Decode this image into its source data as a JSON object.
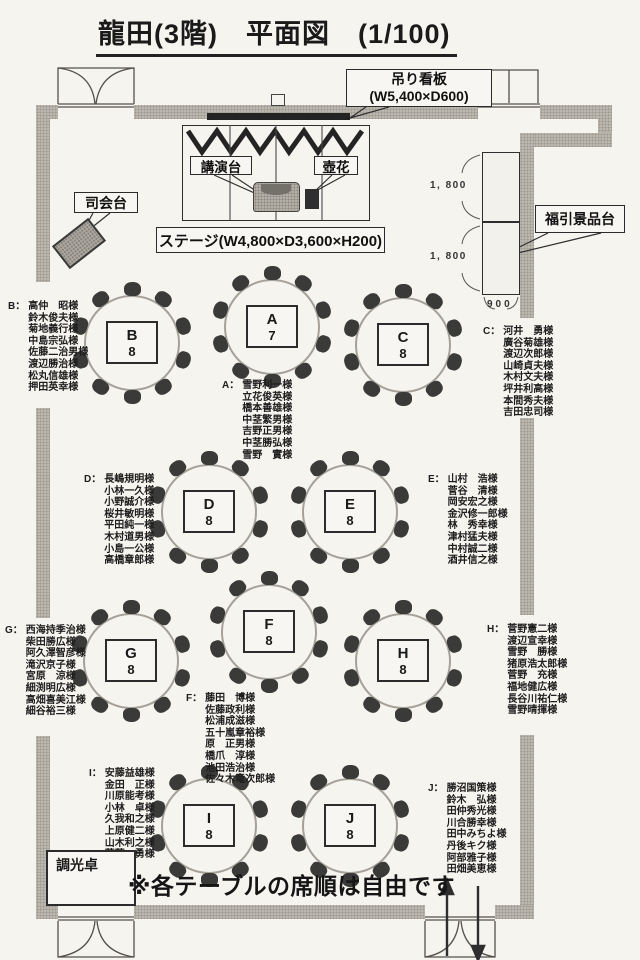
{
  "title": "龍田(3階)　平面図　(1/100)",
  "stage": {
    "label": "ステージ(W4,800×D3,600×H200)",
    "podium_label": "講演台",
    "flower_label": "壺花",
    "mc_label": "司会台",
    "sign_line1": "吊り看板",
    "sign_line2": "(W5,400×D600)"
  },
  "prize_table": {
    "label": "福引景品台",
    "dim_top": "1, 800",
    "dim_bottom": "1, 800",
    "dim_width": "900"
  },
  "dimmer_label": "調光卓",
  "note": "※各テーブルの席順は自由です",
  "tables": [
    {
      "letter": "A",
      "count": "7",
      "list_label": "A：",
      "names": [
        "雪野利一様",
        "立花俊英様",
        "橋本善雄様",
        "中茎繁男様",
        "吉野正男様",
        "中茎勝弘様",
        "雪野　實様"
      ]
    },
    {
      "letter": "B",
      "count": "8",
      "list_label": "B：",
      "names": [
        "高仲　昭様",
        "鈴木俊夫様",
        "菊地義行様",
        "中島宗弘様",
        "佐藤二治男様",
        "渡辺勝治様",
        "松丸信雄様",
        "押田英幸様"
      ]
    },
    {
      "letter": "C",
      "count": "8",
      "list_label": "C：",
      "names": [
        "河井　勇様",
        "廣谷菊雄様",
        "渡辺次郎様",
        "山崎貞夫様",
        "木村文夫様",
        "坪井利高様",
        "本間秀夫様",
        "吉田忠司様"
      ]
    },
    {
      "letter": "D",
      "count": "8",
      "list_label": "D：",
      "names": [
        "長嶋規明様",
        "小林一久様",
        "小野誠介様",
        "桜井敏明様",
        "平田純一様",
        "木村道男様",
        "小島一公様",
        "高橋章郎様"
      ]
    },
    {
      "letter": "E",
      "count": "8",
      "list_label": "E：",
      "names": [
        "山村　浩様",
        "菅谷　清様",
        "岡安宏之様",
        "金沢修一郎様",
        "林　秀幸様",
        "津村猛夫様",
        "中村誠二様",
        "酒井信之様"
      ]
    },
    {
      "letter": "F",
      "count": "8",
      "list_label": "F：",
      "names": [
        "藤田　博様",
        "佐藤政利様",
        "松浦成滋様",
        "五十嵐章裕様",
        "原　正男様",
        "橋爪　淳様",
        "池田浩治様",
        "佐々木竜次郎様"
      ]
    },
    {
      "letter": "G",
      "count": "8",
      "list_label": "G：",
      "names": [
        "西海持季治様",
        "柴田勝広様",
        "阿久澤智彦様",
        "滝沢京子様",
        "宮原　涼様",
        "細渕明広様",
        "高畑喜美江様",
        "細谷裕三様"
      ]
    },
    {
      "letter": "H",
      "count": "8",
      "list_label": "H：",
      "names": [
        "菅野憲二様",
        "渡辺宣幸様",
        "雪野　勝様",
        "猪原浩太郎様",
        "菅野　充様",
        "福地健広様",
        "長谷川祐仁様",
        "雪野晴揮様"
      ]
    },
    {
      "letter": "I",
      "count": "8",
      "list_label": "I：",
      "names": [
        "安藤益雄様",
        "金田　正様",
        "川原能考様",
        "小林　卓様",
        "久我和之様",
        "上原健二様",
        "山木利之様",
        "葭葉　勇様"
      ]
    },
    {
      "letter": "J",
      "count": "8",
      "list_label": "J：",
      "names": [
        "勝沼国策様",
        "鈴木　弘様",
        "田仲秀光様",
        "川合勝幸様",
        "田中みちよ様",
        "丹後キク様",
        "阿部雅子様",
        "田畑美恵様"
      ]
    }
  ]
}
